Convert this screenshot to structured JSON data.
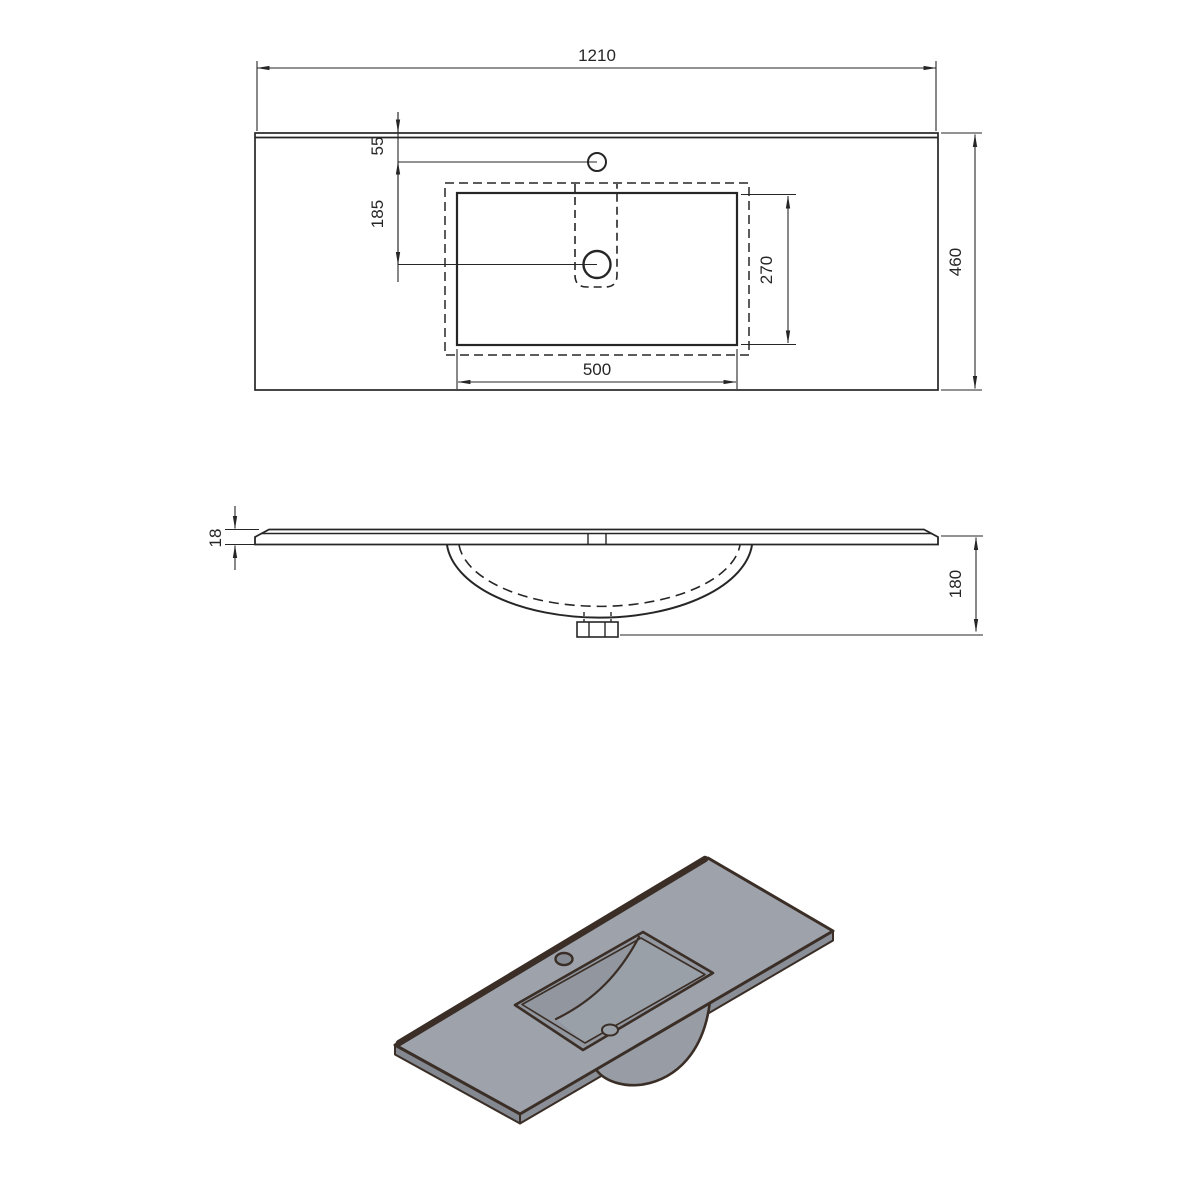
{
  "drawing": {
    "subject": "vanity-washbasin-countertop-technical-drawing",
    "views": {
      "top_view": {
        "overall_width": "1210",
        "overall_depth": "460",
        "faucet_offset_from_back": "55",
        "drain_offset_from_faucet": "185",
        "basin_cutout_width": "500",
        "basin_cutout_depth": "270"
      },
      "side_view": {
        "top_edge_thickness": "18",
        "overall_height_with_bowl": "180"
      }
    },
    "colors": {
      "line": "#262626",
      "iso_outline": "#3a2e26",
      "iso_top_surface": "#9da2ab",
      "iso_basin_wall": "#91969f",
      "iso_basin_floor": "#9aa0a8",
      "iso_edge_band": "#8a8f97",
      "iso_bowl_bulge": "#989da5"
    }
  }
}
